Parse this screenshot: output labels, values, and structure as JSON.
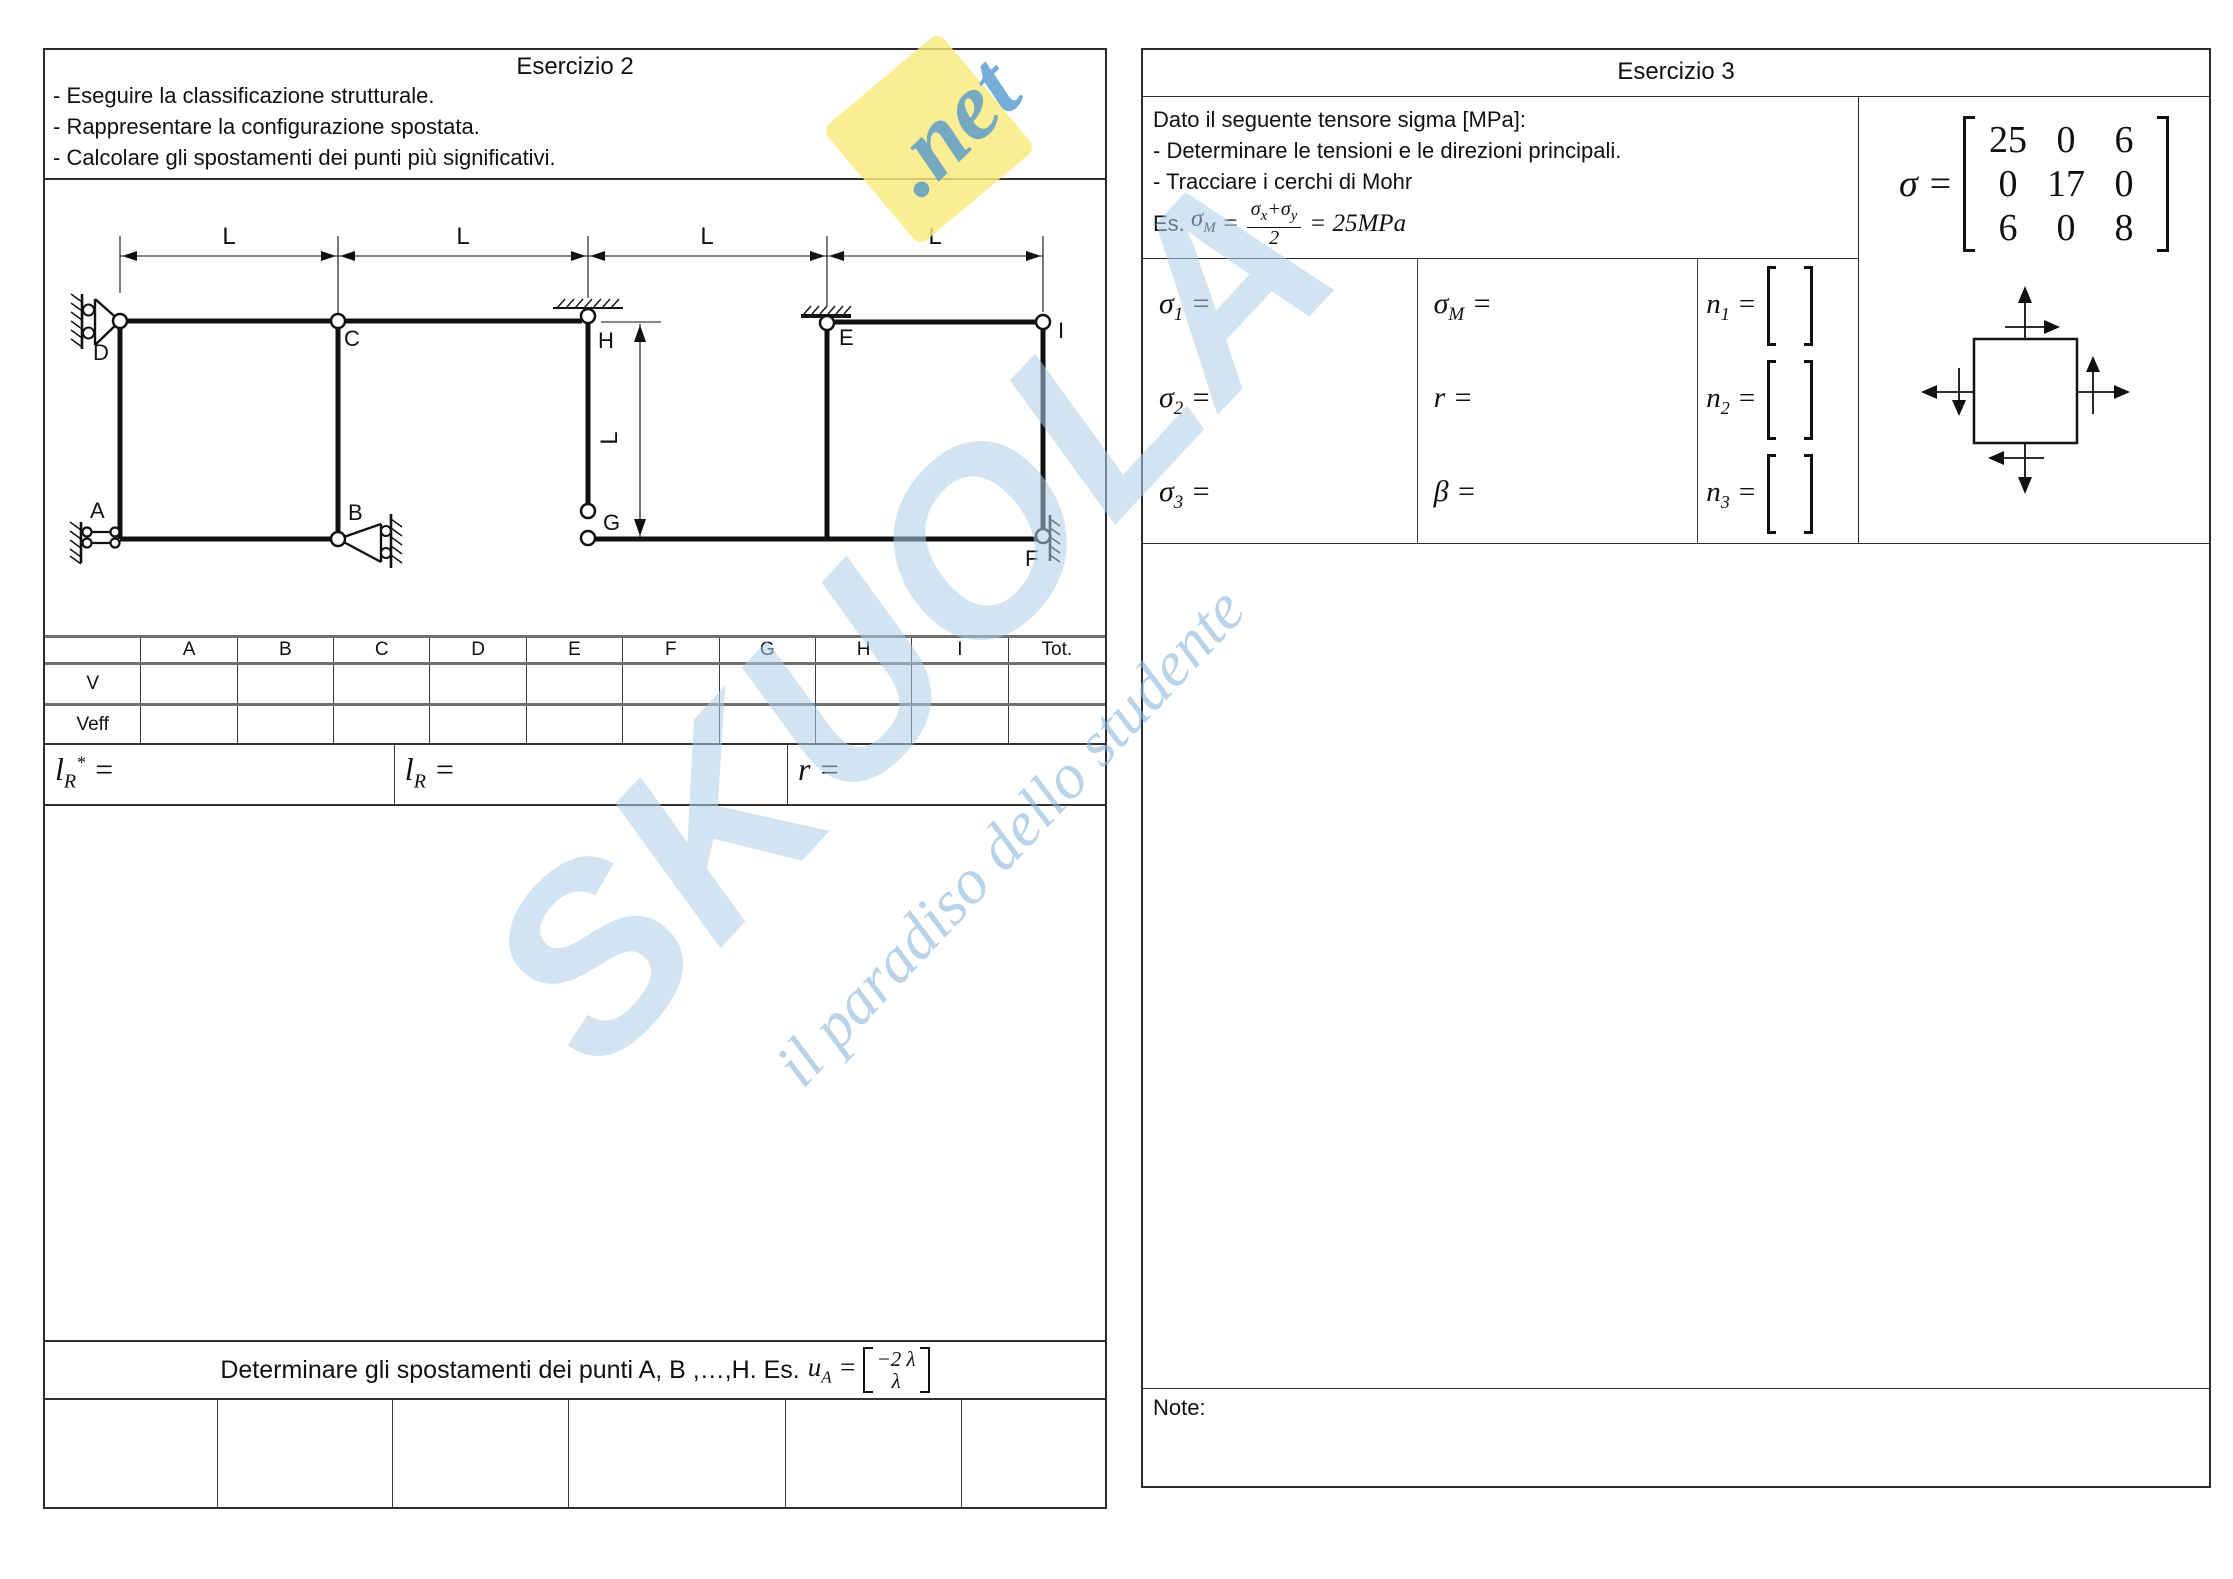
{
  "watermark": {
    "word": "SKUOLA",
    "dot": ".",
    "net": "net",
    "tagline": "il paradiso dello studente",
    "word_color": "#adcce8",
    "net_color": "#5096cd",
    "diamond_color": "#f9e97c"
  },
  "ex2": {
    "title": "Esercizio 2",
    "bullets": [
      "- Eseguire la classificazione strutturale.",
      "- Rappresentare la configurazione spostata.",
      "- Calcolare gli spostamenti dei punti più significativi."
    ],
    "diagram": {
      "dim_labels": [
        "L",
        "L",
        "L",
        "L"
      ],
      "dim_vertical": "L",
      "nodes": {
        "A": "A",
        "B": "B",
        "C": "C",
        "D": "D",
        "E": "E",
        "F": "F",
        "G": "G",
        "H": "H",
        "I": "I"
      }
    },
    "table": {
      "col_headers": [
        "",
        "A",
        "B",
        "C",
        "D",
        "E",
        "F",
        "G",
        "H",
        "I",
        "Tot."
      ],
      "row_labels": [
        "V",
        "Veff"
      ]
    },
    "formulas": {
      "lr_star": {
        "base": "l",
        "sub": "R",
        "sup": "*",
        "eq": " ="
      },
      "lr": {
        "base": "l",
        "sub": "R",
        "eq": " ="
      },
      "r": {
        "base": "r",
        "eq": " ="
      }
    },
    "determinare": {
      "prefix": "Determinare gli spostamenti dei punti A, B ,…,H. Es.",
      "u": "u",
      "u_sub": "A",
      "eq": " =",
      "vec_top": "−2 λ",
      "vec_bottom": "λ"
    }
  },
  "ex3": {
    "title": "Esercizio 3",
    "intro": [
      "Dato il seguente tensore sigma [MPa]:",
      "- Determinare le tensioni e le direzioni principali.",
      "- Tracciare i cerchi di Mohr"
    ],
    "es_formula": {
      "prefix": "Es.",
      "sym": "σ",
      "sub": "M",
      "eq": "=",
      "num_s1": "σ",
      "num_s1sub": "x",
      "num_plus": "+",
      "num_s2": "σ",
      "num_s2sub": "y",
      "den": "2",
      "eq2": "=",
      "rhs": "25MPa"
    },
    "sigma_fields": [
      {
        "sym": "σ",
        "sub": "1",
        "eq": " ="
      },
      {
        "sym": "σ",
        "sub": "2",
        "eq": " ="
      },
      {
        "sym": "σ",
        "sub": "3",
        "eq": " ="
      }
    ],
    "mid_fields": [
      {
        "sym": "σ",
        "sub": "M",
        "eq": " ="
      },
      {
        "sym": "r",
        "sub": "",
        "eq": " ="
      },
      {
        "sym": "β",
        "sub": "",
        "eq": " ="
      }
    ],
    "n_fields": [
      {
        "sym": "n",
        "sub": "1",
        "eq": " ="
      },
      {
        "sym": "n",
        "sub": "2",
        "eq": " ="
      },
      {
        "sym": "n",
        "sub": "3",
        "eq": " ="
      }
    ],
    "matrix": {
      "lhs": "σ",
      "eq": " =",
      "rows": [
        [
          "25",
          "0",
          "6"
        ],
        [
          "0",
          "17",
          "0"
        ],
        [
          "6",
          "0",
          "8"
        ]
      ]
    },
    "note_label": "Note:"
  }
}
